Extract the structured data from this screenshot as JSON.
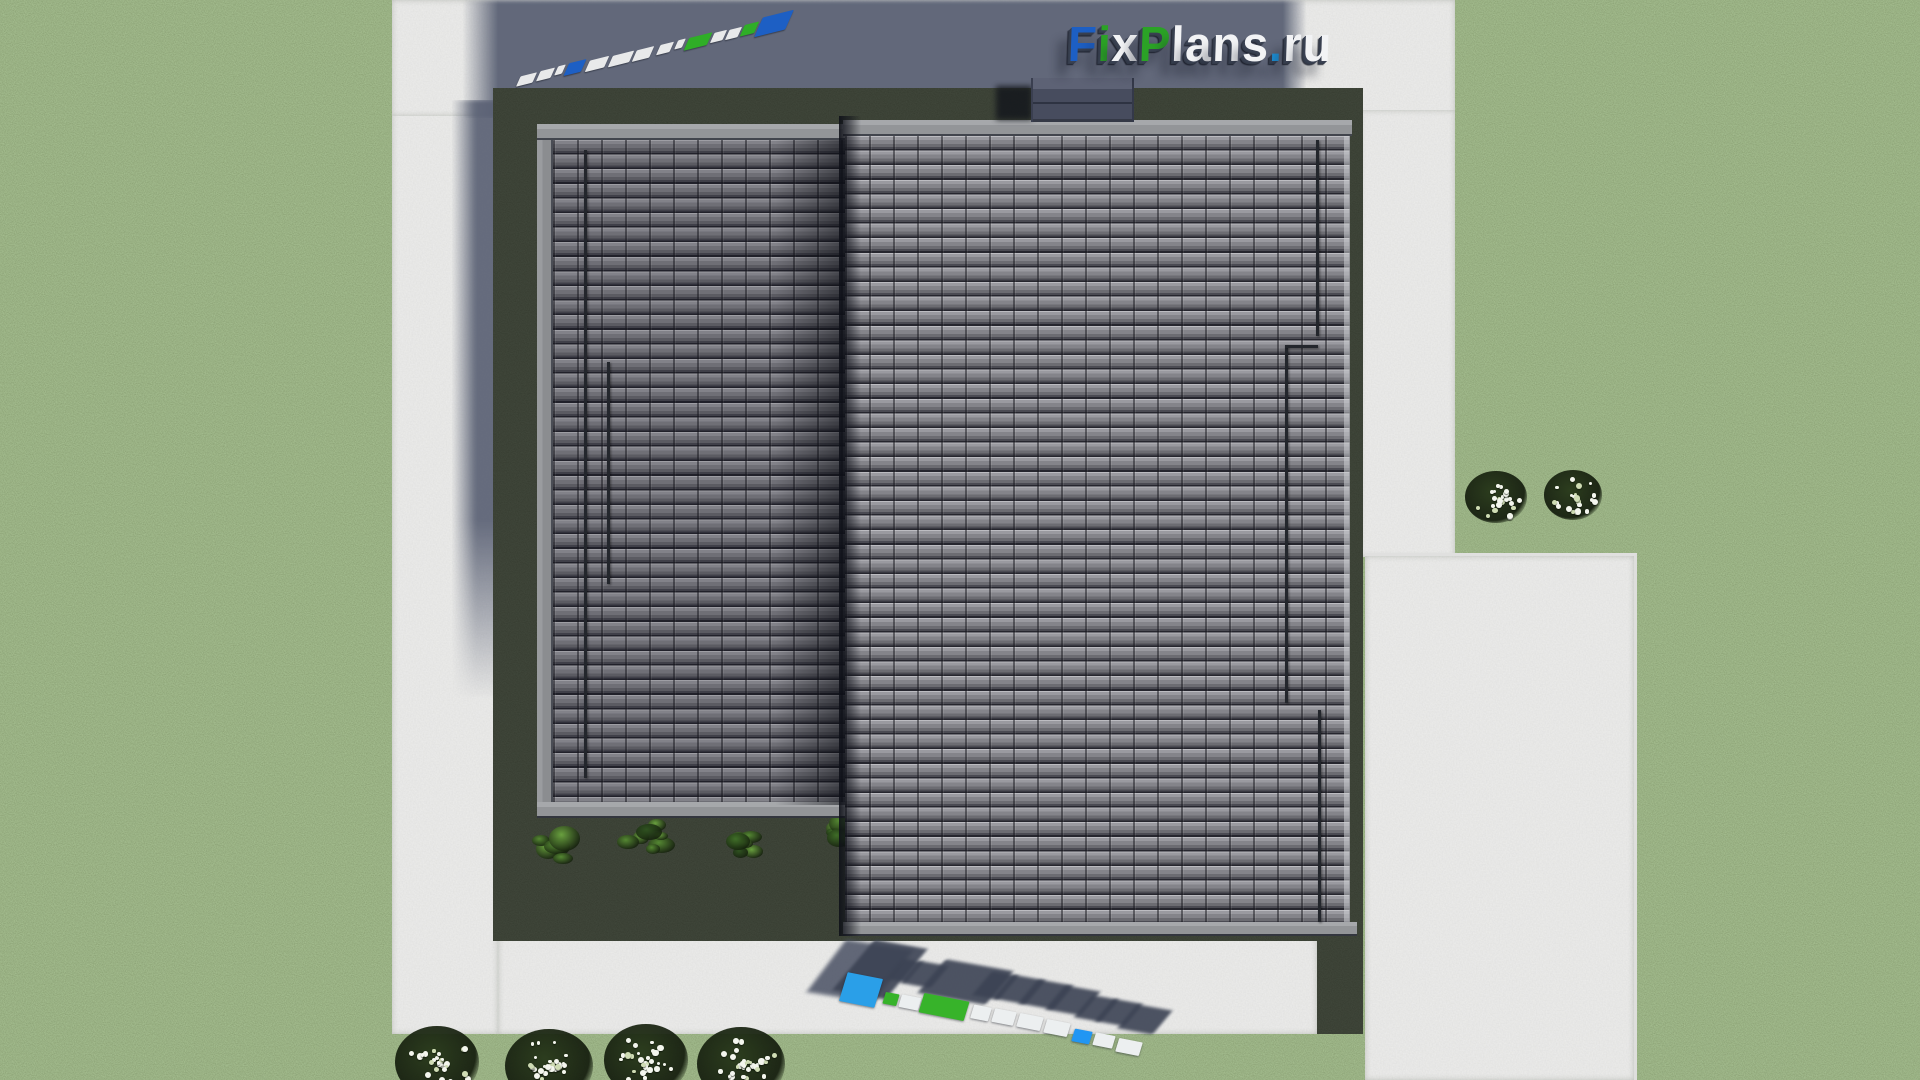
{
  "brand": {
    "name": "FixPlans.ru",
    "logo_letters": [
      {
        "ch": "F",
        "color": "#1d5fc4"
      },
      {
        "ch": "i",
        "color": "#2ba226"
      },
      {
        "ch": "x",
        "color": "#f2f3f5"
      },
      {
        "ch": "P",
        "color": "#2ba226"
      },
      {
        "ch": "l",
        "color": "#f2f3f5"
      },
      {
        "ch": "a",
        "color": "#f2f3f5"
      },
      {
        "ch": "n",
        "color": "#f2f3f5"
      },
      {
        "ch": "s",
        "color": "#f2f3f5"
      },
      {
        "ch": ".",
        "color": "#1e9be6"
      },
      {
        "ch": "r",
        "color": "#f2f3f5"
      },
      {
        "ch": "u",
        "color": "#f2f3f5"
      }
    ]
  },
  "watermarks": {
    "top_strip_colors": [
      "#e8e9ea",
      "#e8e9ea",
      "#e8e9ea",
      "#1d5fc4",
      "#e8e9ea",
      "#e8e9ea",
      "#e8e9ea",
      "#e8e9ea",
      "#e8e9ea",
      "#2fae27",
      "#e8e9ea",
      "#e8e9ea",
      "#2fae27",
      "#1d5fc4"
    ],
    "bottom_strip_colors": [
      "#2a9fe8",
      "#37b32a",
      "#eceff0",
      "#37b32a",
      "#eceff0",
      "#eceff0",
      "#eceff0",
      "#eceff0",
      "#2196f3",
      "#eceff0",
      "#eceff0"
    ]
  },
  "palette": {
    "grass": "#52703a",
    "grass_shadowed": "#242e1e",
    "concrete": "#c7c7c5",
    "concrete_shadow": "#5a6174",
    "roof_tile_light": "#9a9aa0",
    "roof_tile_dark": "#26262e",
    "roof_trim": "#9b9da0",
    "chimney": "#474c5e",
    "flower_white": "#f4f6ee",
    "shrub_green": "#558833"
  }
}
